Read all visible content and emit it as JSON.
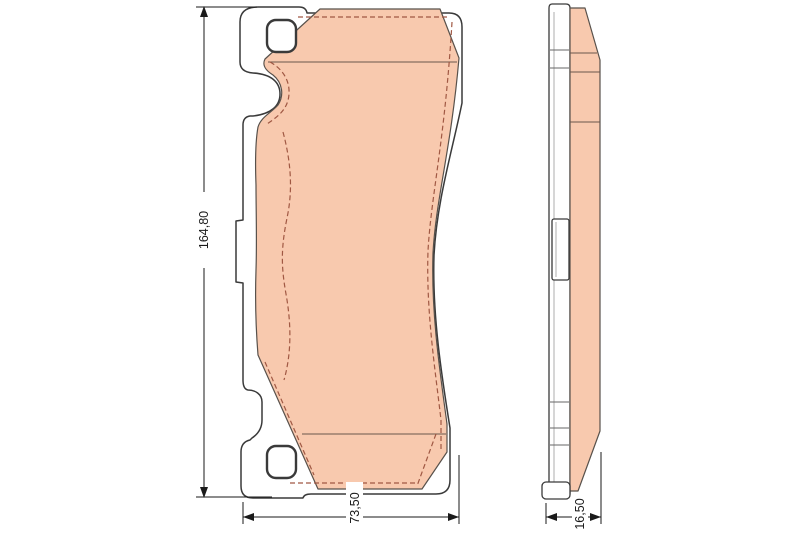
{
  "drawing": {
    "dimension_labels": {
      "height": "164,80",
      "width": "73,50",
      "thickness": "16,50"
    },
    "colors": {
      "friction_material": "#f8c9ae",
      "backing_plate": "#ffffff",
      "outline": "#3a3a3a",
      "friction_outline": "#58514b",
      "hidden_line": "#a05843",
      "chamfer_line": "#6a564c",
      "dimension_line": "#1a1a1a",
      "background": "#ffffff"
    }
  }
}
